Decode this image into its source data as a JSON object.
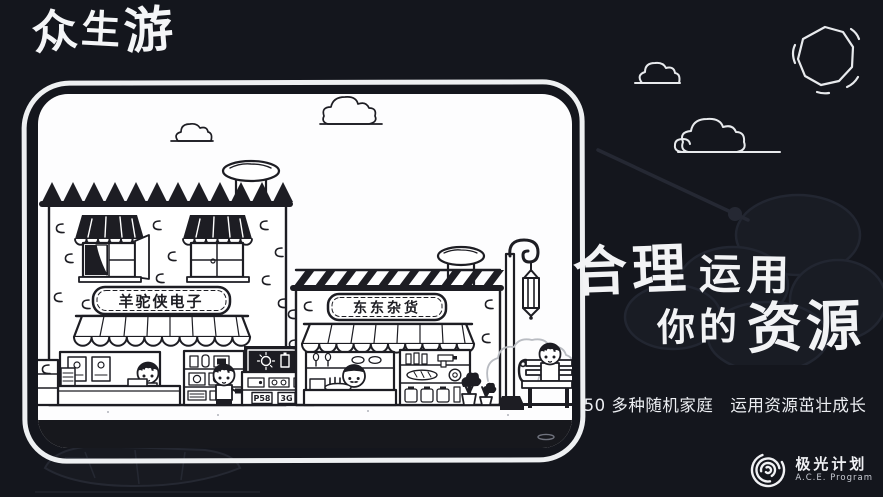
{
  "colors": {
    "background": "#14161d",
    "ink": "#1d1d23",
    "paper": "#fdfdfe",
    "frame_stroke": "#eef0f2"
  },
  "title": {
    "chars": [
      "众",
      "生",
      "游"
    ]
  },
  "illustration": {
    "shops": [
      {
        "name": "羊驼侠电子",
        "kind": "electronics-shop",
        "price_tags": [
          "P58",
          "3G"
        ]
      },
      {
        "name": "东东杂货",
        "kind": "grocery-shop"
      }
    ]
  },
  "tagline": {
    "part1": "合理",
    "part2": "运用",
    "part3": "你的",
    "part4": "资源"
  },
  "subtitle": "50 多种随机家庭　运用资源茁壮成长",
  "branding": {
    "name": "极光计划",
    "program": "A.C.E. Program"
  }
}
